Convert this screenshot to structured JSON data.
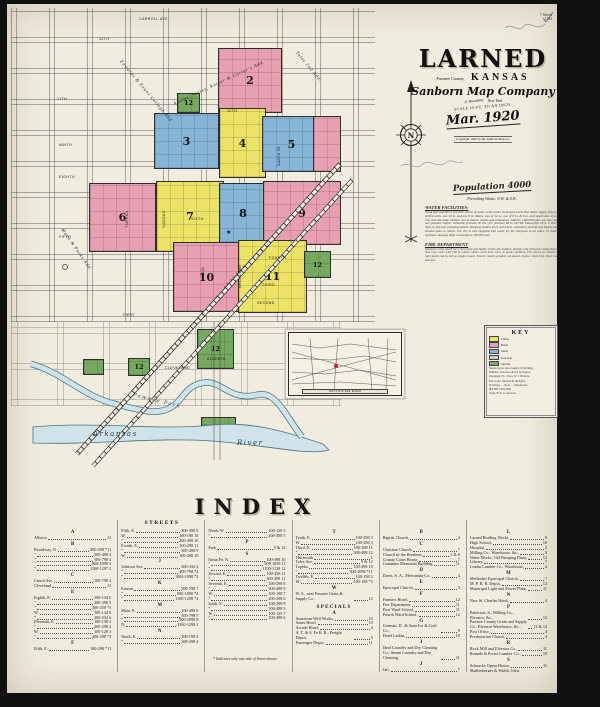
{
  "corner": {
    "line1": "7 Sheets",
    "line2": "1382"
  },
  "title": {
    "name": "LARNED",
    "county": "Pawnee County",
    "state": "KANSAS",
    "company": "Sanborn Map Company",
    "address": "11 Broadway",
    "city": "New York",
    "scale": "SCALE 50 FT. TO AN INCH.",
    "date": "Mar. 1920",
    "copyright": "Copyright 1920 by the Sanborn Map Co."
  },
  "stats": {
    "population": "Population 4000",
    "winds": "Prevailing Winds: N.W. & S.W.",
    "water_heading": "WATER FACILITIES:",
    "water_text": "Stand pipe and direct pressure system of water works under municipal ownership. Water supply from two drilled wells, one 10 in. and one 8 in. Mains: two of 12 in., one of 8 in. & 6 in. and small sizes of cast iron and steel pipe. Pumps: two at station, duplex and compound, capacity 1,000,000 gals. per day; also one gasoline engine. Domestic pressure 40 lbs., fire pressure 80 to 100 lbs. Stand pipe 16 ft. x 100 ft. high on hill near pumping station. Pumping station brick and frame, situated at Second and Topeka Ave. Double gates in mains. The city is well supplied with water for fire purposes at all times. 72 double hydrants. Average daily consumption 100,000 gals.",
    "fire_heading": "FIRE DEPARTMENT",
    "fire_text": "Volunteer chief and 8 men. One hook and ladder truck with ladders, buckets and chemical extinguishers. Two hose carts with 500 ft. cotton rubber lined hose each, in good condition. Fire alarm by whistle at light plant and by bell at engine house. Streets: mostly graded, not paved. Lights: electricity. Fuel: coal and gas."
  },
  "map": {
    "blocks": [
      {
        "label": "2",
        "color": "pink"
      },
      {
        "label": "12",
        "color": "green"
      },
      {
        "label": "3",
        "color": "blue"
      },
      {
        "label": "4",
        "color": "yellow"
      },
      {
        "label": "5",
        "color": "blue"
      },
      {
        "label": "",
        "color": "pink"
      },
      {
        "label": "6",
        "color": "pink"
      },
      {
        "label": "7",
        "color": "yellow"
      },
      {
        "label": "8",
        "color": "blue"
      },
      {
        "label": "9",
        "color": "pink"
      },
      {
        "label": "10",
        "color": "pink"
      },
      {
        "label": "11",
        "color": "yellow"
      },
      {
        "label": "12",
        "color": "green"
      },
      {
        "label": "12",
        "color": "green"
      },
      {
        "label": "12",
        "color": "green"
      },
      {
        "label": "",
        "color": "green"
      },
      {
        "label": "12",
        "color": "green"
      }
    ],
    "labels": {
      "carroll": "CARROLL AVE.",
      "t12": "12TH",
      "t11": "11TH",
      "t10": "10TH",
      "ninth": "NINTH",
      "eighth": "EIGHTH",
      "sixth": "SIXTH",
      "fifth": "FIFTH",
      "fourth": "FOURTH",
      "third": "THIRD",
      "second": "SECOND",
      "first": "FIRST",
      "cleveland": "CLEVELAND",
      "alberta": "ALBERTA",
      "topeka": "TOPEKA",
      "kansas": "KANSAS",
      "main": "MAIN",
      "broadway": "BROADWAY",
      "santafe": "SANTA FE",
      "add_college": "Edwards & Evans College Add.",
      "add_adams": "Adams, Storey, Keiser & Carter's Add.",
      "add_mann": "Mann & Parks Add.",
      "add_toles": "Toles 2nd Add.",
      "railroad": "A. T. & S. F. R. R.",
      "creek": "Pawnee Fork",
      "river_a": "Arkansas",
      "river_b": "River",
      "compass_n": "N",
      "star": "★"
    }
  },
  "key": {
    "title": "KEY",
    "rows": [
      {
        "sw": "#ece266",
        "label": "Frame"
      },
      {
        "sw": "#e89fb1",
        "label": "Brick"
      },
      {
        "sw": "#87b5d8",
        "label": "Stone"
      },
      {
        "sw": "#c9c9c9",
        "label": "Iron clad"
      },
      {
        "sw": "#74a95e",
        "label": "Special"
      }
    ],
    "lines": [
      {
        "t": "Shaded parts show height of buildings."
      },
      {
        "t": "Number of stories shown by figures."
      },
      {
        "t": "Openings: D = Door, W = Window."
      },
      {
        "t": "Fire walls, shutters & skylights."
      },
      {
        "t": "Dwelling — Store — Warehouse."
      },
      {
        "t": "✚  FIRE STATION"
      },
      {
        "t": "Scale 50 ft. to one inch."
      }
    ]
  },
  "inset": {
    "caption": "SKETCH OF RAIL ROADS",
    "marker_color": "#b23434"
  },
  "index": {
    "heading": "INDEX",
    "streets_heading": "STREETS",
    "specials_heading": "SPECIALS",
    "footnote": "* Indicates only one side of Street shown.",
    "col1": [
      {
        "h": "A"
      },
      {
        "t": "Alberta",
        "n": "12"
      },
      {
        "h": "B"
      },
      {
        "t": "Broadway, N.",
        "n": "200-298 *11"
      },
      {
        "t": "”",
        "n": "300-498  4"
      },
      {
        "t": "”",
        "n": "500-798  4"
      },
      {
        "t": "”",
        "n": "800-1098  5"
      },
      {
        "t": "”",
        "n": "1100-1297  2"
      },
      {
        "h": "C"
      },
      {
        "t": "Carrol Ave.",
        "n": "100-798  4"
      },
      {
        "t": "Cleveland",
        "n": "12"
      },
      {
        "h": "E"
      },
      {
        "t": "Eighth, E.",
        "n": "100-134  5"
      },
      {
        "t": "”",
        "n": "200-298  5"
      },
      {
        "t": "”",
        "n": "300-458 *5"
      },
      {
        "t": "W.",
        "n": "100-134  6"
      },
      {
        "t": "”",
        "n": "200-334  6"
      },
      {
        "t": "Eleventh, E.",
        "n": "100-158  2"
      },
      {
        "t": "”",
        "n": "200-298  2"
      },
      {
        "t": "W.",
        "n": "100-128  3"
      },
      {
        "t": "”",
        "n": "200-298 *3"
      },
      {
        "h": "F"
      },
      {
        "t": "Fifth, E.",
        "n": "100-298 *11"
      }
    ],
    "col2": [
      {
        "t": "Fifth, E.",
        "n": "300-498  9"
      },
      {
        "t": "W.",
        "n": "100-198  10"
      },
      {
        "t": "”",
        "n": "200-498  10"
      },
      {
        "t": "Fourth, E.",
        "n": "100-298  11"
      },
      {
        "t": "”",
        "n": "300-498  9"
      },
      {
        "t": "W.",
        "n": "100-298  10"
      },
      {
        "h": "J"
      },
      {
        "t": "Johnson Ave.",
        "n": "300-334  4"
      },
      {
        "t": "”",
        "n": "400-798 *4"
      },
      {
        "t": "”",
        "n": "1004-1098 *2"
      },
      {
        "h": "K"
      },
      {
        "t": "Kansas",
        "n": "500-798  7"
      },
      {
        "t": "”",
        "n": "800-1098 *4"
      },
      {
        "t": "”",
        "n": "1100-1298 *2"
      },
      {
        "h": "M"
      },
      {
        "t": "Main, E.",
        "n": "100-498  6"
      },
      {
        "t": "”",
        "n": "500-798  7"
      },
      {
        "t": "”",
        "n": "800-1098  8"
      },
      {
        "t": "N.",
        "n": "1100-1298  2"
      },
      {
        "h": "N"
      },
      {
        "t": "Ninth, E.",
        "n": "100-198  4"
      },
      {
        "t": "”",
        "n": "200-298  4"
      }
    ],
    "col3": [
      {
        "t": "Ninth, W.",
        "n": "100-120  5"
      },
      {
        "t": "”",
        "n": "200-498  5"
      },
      {
        "h": "P"
      },
      {
        "t": "Park",
        "n": "5 & 12"
      },
      {
        "t": "Patmos, see Cleveland.",
        "n": ""
      },
      {
        "h": "S"
      },
      {
        "t": "Santa Fe, N.",
        "n": "100-498  10"
      },
      {
        "t": "”",
        "n": "500-1098  11"
      },
      {
        "t": "”",
        "n": "1100-1128  12"
      },
      {
        "t": "Second, E.",
        "n": "100-298  11"
      },
      {
        "t": "”",
        "n": "300-498  12"
      },
      {
        "t": "Seventh, E.",
        "n": "100-298  8"
      },
      {
        "t": "”",
        "n": "300-498  9"
      },
      {
        "t": "W.",
        "n": "100-198  7"
      },
      {
        "t": "”",
        "n": "200-298  6"
      },
      {
        "t": "Sixth, E.",
        "n": "100-298  8"
      },
      {
        "t": "”",
        "n": "300-498  9"
      },
      {
        "t": "W.",
        "n": "100-125  7"
      },
      {
        "t": "”",
        "n": "200-498  6"
      }
    ],
    "col4": [
      {
        "h": "T"
      },
      {
        "t": "Tenth, E.",
        "n": "100-298  3"
      },
      {
        "t": "W.",
        "n": "100-298  3"
      },
      {
        "t": "Third, E.",
        "n": "100-298  11"
      },
      {
        "t": "”",
        "n": "300-498  12"
      },
      {
        "t": "Thirteenth",
        "n": "1"
      },
      {
        "t": "Toles Ave.",
        "n": "9 & 12"
      },
      {
        "t": "Topeka",
        "n": "100-498  10"
      },
      {
        "t": "”",
        "n": "500-1098 *11"
      },
      {
        "t": "Twelfth, E.",
        "n": "100-198  2"
      },
      {
        "t": "W.",
        "n": "100-198 *3"
      },
      {
        "h": "W"
      },
      {
        "t": "W. S., near Pawnee Grain & Supply Co.",
        "n": "12"
      }
    ],
    "col4b": [
      {
        "h": "A"
      },
      {
        "t": "American Well Works,",
        "n": "10"
      },
      {
        "t": "Ames Hotel,",
        "n": "10"
      },
      {
        "t": "Arcade Hotel,",
        "n": "4"
      },
      {
        "t": "A. T. & S. Fe R. R., Freight Depot,",
        "n": "9"
      },
      {
        "t": "Passenger Depot,",
        "n": "11"
      }
    ],
    "col5": [
      {
        "h": "B"
      },
      {
        "t": "Baptist Church,",
        "n": "4"
      },
      {
        "h": "C"
      },
      {
        "t": "Christian Church,",
        "n": "7"
      },
      {
        "t": "Church of the Brethren,",
        "n": "1 & 6"
      },
      {
        "t": "County Court House,",
        "n": "7"
      },
      {
        "t": "Cummins Memorial Building,",
        "n": "11"
      },
      {
        "h": "D"
      },
      {
        "t": "Doerr, A. A., Mercantile Co.,",
        "n": "4"
      },
      {
        "h": "E"
      },
      {
        "t": "Episcopal Church,",
        "n": "3"
      },
      {
        "h": "F"
      },
      {
        "t": "Farmers Hotel,",
        "n": "12"
      },
      {
        "t": "Fire Department,",
        "n": "11"
      },
      {
        "t": "First Ward School,",
        "n": "11"
      },
      {
        "t": "Fourth Ward School,",
        "n": "12"
      },
      {
        "h": "G"
      },
      {
        "t": "Gorman, D., & Sons Ice & Coal Co.,",
        "n": "9"
      },
      {
        "t": "Hotel Larkin,",
        "n": "10"
      },
      {
        "h": "I"
      },
      {
        "t": "Ideal Laundry and Dry Cleaning Co., Steam Laundry and Dry Cleaning,",
        "n": "11"
      },
      {
        "h": "J"
      },
      {
        "t": "Jail,",
        "n": "7"
      },
      {
        "h": "K"
      },
      {
        "t": "Kansas Flour Mill, Elevator,",
        "n": "9"
      },
      {
        "t": "Keystone Milling Co., Elevators & Flour Mills,",
        "n": "10"
      }
    ],
    "col6": [
      {
        "h": "L"
      },
      {
        "t": "Larned Bottling Works,",
        "n": "9"
      },
      {
        "t": "High School,",
        "n": "10"
      },
      {
        "t": "Hospital,",
        "n": "2"
      },
      {
        "t": "Milling Co., Warehouse, &c.,",
        "n": "9"
      },
      {
        "t": "Water Works, Old Pumping Plant,",
        "n": "12"
      },
      {
        "t": "Library,",
        "n": "7"
      },
      {
        "t": "Lindas Lumber Co., Warehouse,",
        "n": "4"
      },
      {
        "h": "M"
      },
      {
        "t": "Methodist Episcopal Church,",
        "n": "7"
      },
      {
        "t": "M. P. R. R. Depot,",
        "n": "12"
      },
      {
        "t": "Municipal Light and Power Plant,",
        "n": "11"
      },
      {
        "h": "N"
      },
      {
        "t": "New St. Charles Hotel,",
        "n": "4"
      },
      {
        "h": "P"
      },
      {
        "t": "Patterson, S., Milling Co., Elevator, &c.,",
        "n": "12"
      },
      {
        "t": "Pawnee County Grain and Supply Co., Elevator Warehouse, &c.,",
        "n": "11 & 12"
      },
      {
        "t": "Post Office,",
        "n": "4"
      },
      {
        "t": "Presbyterian Church,",
        "n": "4"
      },
      {
        "h": "R"
      },
      {
        "t": "Rock Mill and Elevator Co.,",
        "n": "11"
      },
      {
        "t": "Rounds & Porter Lumber Co.,",
        "n": "10"
      },
      {
        "h": "S"
      },
      {
        "t": "Schnacks Opera House,",
        "n": "11"
      },
      {
        "t": "Shallenberger & Walsh, Grist Mill,",
        "n": "11"
      },
      {
        "h": "T"
      },
      {
        "t": "Third Ward School,",
        "n": "6"
      }
    ]
  }
}
